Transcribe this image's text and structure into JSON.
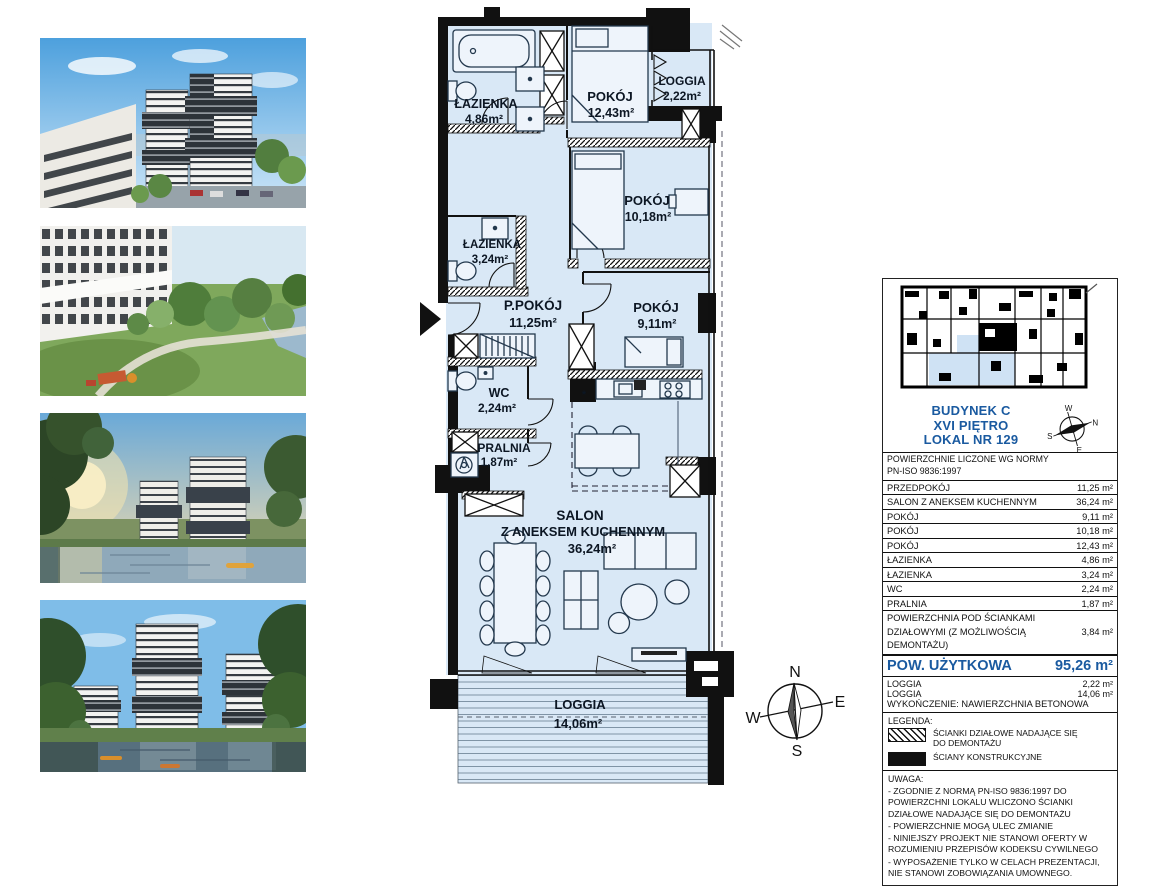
{
  "colors": {
    "accent_blue": "#1a5aa0",
    "floor_blue": "#d9e8f6",
    "wall_black": "#111111"
  },
  "plan": {
    "kitchen_marker": "*",
    "rooms": [
      {
        "name": "ŁAZIENKA",
        "area": "4,86m²"
      },
      {
        "name": "POKÓJ",
        "area": "12,43m²"
      },
      {
        "name": "LOGGIA",
        "area": "2,22m²"
      },
      {
        "name": "POKÓJ",
        "area": "10,18m²"
      },
      {
        "name": "ŁAZIENKA",
        "area": "3,24m²"
      },
      {
        "name": "P.POKÓJ",
        "area": "11,25m²"
      },
      {
        "name": "POKÓJ",
        "area": "9,11m²"
      },
      {
        "name": "WC",
        "area": "2,24m²"
      },
      {
        "name": "PRALNIA",
        "area": "1,87m²"
      },
      {
        "name": "SALON",
        "name2": "Z ANEKSEM KUCHENNYM",
        "area": "36,24m²"
      },
      {
        "name": "LOGGIA",
        "area": "14,06m²"
      }
    ],
    "compass": {
      "n": "N",
      "e": "E",
      "s": "S",
      "w": "W"
    }
  },
  "panel": {
    "title_lines": [
      "BUDYNEK C",
      "XVI PIĘTRO",
      "LOKAL NR 129"
    ],
    "compass": {
      "n": "N",
      "e": "E",
      "s": "S",
      "w": "W"
    },
    "table": {
      "header_lines": [
        "POWIERZCHNIE LICZONE WG NORMY",
        "PN-ISO 9836:1997"
      ],
      "rows": [
        {
          "label": "PRZEDPOKÓJ",
          "value": "11,25 m²"
        },
        {
          "label": "SALON Z ANEKSEM KUCHENNYM",
          "value": "36,24 m²"
        },
        {
          "label": "POKÓJ",
          "value": "9,11 m²"
        },
        {
          "label": "POKÓJ",
          "value": "10,18 m²"
        },
        {
          "label": "POKÓJ",
          "value": "12,43 m²"
        },
        {
          "label": "ŁAZIENKA",
          "value": "4,86 m²"
        },
        {
          "label": "ŁAZIENKA",
          "value": "3,24 m²"
        },
        {
          "label": "WC",
          "value": "2,24 m²"
        },
        {
          "label": "PRALNIA",
          "value": "1,87 m²"
        },
        {
          "label": "POWIERZCHNIA POD ŚCIANKAMI DZIAŁOWYMI (Z MOŻLIWOŚCIĄ DEMONTAŻU)",
          "value": "3,84 m²"
        }
      ],
      "total": {
        "label": "POW. UŻYTKOWA",
        "value": "95,26 m²"
      },
      "extra_rows": [
        {
          "label": "LOGGIA",
          "value": "2,22 m²"
        },
        {
          "label": "LOGGIA",
          "value": "14,06 m²"
        }
      ],
      "finish_note": "WYKOŃCZENIE: NAWIERZCHNIA BETONOWA"
    },
    "legend": {
      "title": "LEGENDA:",
      "items": [
        {
          "label": "ŚCIANKI DZIAŁOWE NADAJĄCE SIĘ DO DEMONTAŻU"
        },
        {
          "label": "ŚCIANY KONSTRUKCYJNE"
        }
      ]
    },
    "uwaga": {
      "title": "UWAGA:",
      "lines": [
        "- ZGODNIE Z NORMĄ PN-ISO 9836:1997 DO POWIERZCHNI LOKALU WLICZONO ŚCIANKI DZIAŁOWE NADAJĄCE SIĘ DO DEMONTAŻU",
        "- POWIERZCHNIE MOGĄ ULEC ZMIANIE",
        "- NINIEJSZY PROJEKT NIE STANOWI OFERTY W ROZUMIENIU PRZEPISÓW KODEKSU CYWILNEGO",
        "- WYPOSAŻENIE TYLKO W CELACH PREZENTACJI, NIE STANOWI ZOBOWIĄZANIA UMOWNEGO."
      ]
    }
  }
}
